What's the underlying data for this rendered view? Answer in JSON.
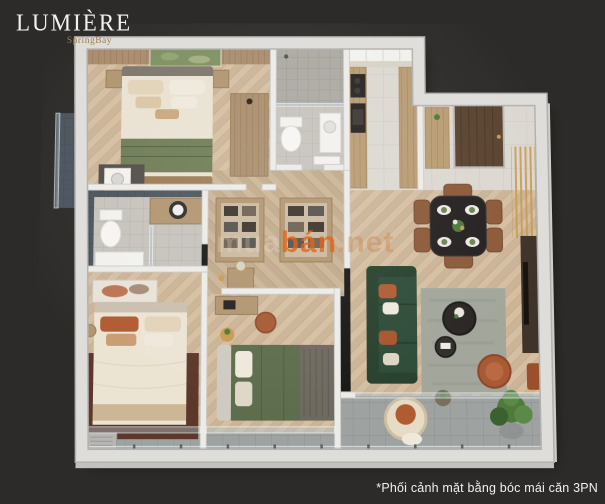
{
  "logo": {
    "title": "LUMIÈRE",
    "subtitle": "SpringBay"
  },
  "watermark": {
    "prefix": "mua",
    "brand": "bán",
    "suffix": ".net"
  },
  "caption": {
    "text": "*Phối cảnh mặt bằng bóc mái căn 3PN"
  },
  "colors": {
    "background": "#2C2B29",
    "wall": "#DEDDDA",
    "woodFloor": "#D5BFA2",
    "corridorWood": "#CBB495",
    "tileGray": "#C6C2BC",
    "marble": "#DCD8D1",
    "balconyTile": "#9EA3A1",
    "slateBlue": "#4C555D",
    "sofaGreen": "#2F4C39",
    "duvetGreen": "#5D6D4D",
    "blanketGreen": "#6E7C55",
    "duvetCream": "#ECE4D3",
    "terracotta": "#B05C33",
    "chairBrown": "#8B5A39",
    "cabinetWood": "#B19570",
    "entryDoor": "#5A4330",
    "brassGold": "#C89B52",
    "tableBlack": "#242120",
    "rugMaroon": "#5C382B",
    "rugLiving": "#A2A69B",
    "plantGreen": "#4E7A3B",
    "watermarkOrange": "#E4651A",
    "logoGold": "#A3794A",
    "textWhite": "#F2F1EF"
  },
  "scene": {
    "view": "3d-cutaway-floor-plan",
    "rooms": [
      "master-bedroom",
      "master-bathroom",
      "kitchen",
      "entry-hall",
      "dining-area",
      "living-room",
      "balcony",
      "bedroom-2",
      "bedroom-3",
      "bathroom-2",
      "corridor-wardrobe",
      "laundry-niche",
      "side-ledge"
    ]
  }
}
